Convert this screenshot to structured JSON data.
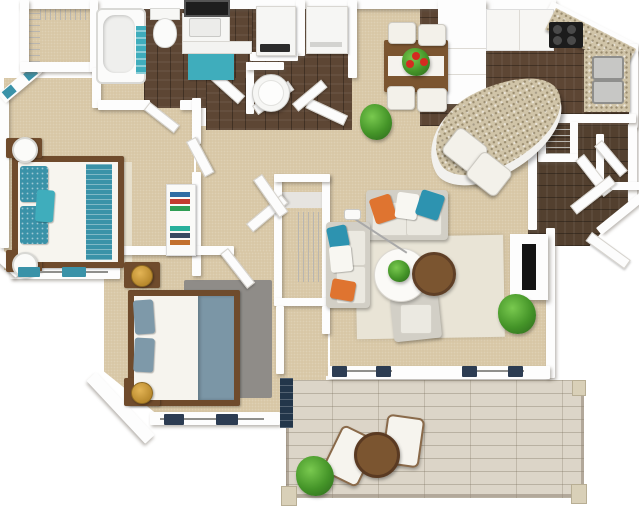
{
  "floorplan": {
    "type": "3d-top-down-apartment-floor-plan",
    "colors": {
      "carpet": "#d8c7a6",
      "wood-dark": "#5d4634",
      "wood-entry": "#53402f",
      "patio-wood": "#dcd5c8",
      "patio-line": "#8f8474",
      "wall": "#fdfdfd",
      "teal": "#3fadbc",
      "teal-deep": "#3a92a8",
      "navy": "#2c3c52",
      "blue-gray": "#7b96a6",
      "orange": "#df7430",
      "blue-pillow": "#2d93b0",
      "sofa": "#d2cfc6",
      "cushion": "#f3f1ea",
      "rug-cream": "#e9e4d6",
      "rug-gray": "#8f8c88",
      "furn-wood": "#6f4b2c",
      "table-wood": "#7b5530",
      "granite": "#d0c4a8",
      "gold": "#b98a2e",
      "plant": "#449428",
      "flower": "#d42b20",
      "tv": "#141414",
      "appliance": "#f6f6f4",
      "door-dark": "#23364a",
      "mirror": "#1e1e1e"
    },
    "rooms": [
      {
        "name": "walk-in-closet",
        "floor": "carpet",
        "features": [
          "wire-shelving"
        ]
      },
      {
        "name": "bathroom",
        "floor": "dark-wood",
        "features": [
          "bathtub",
          "teal-towels",
          "toilet",
          "vanity-sink",
          "mirror",
          "teal-bath-mat"
        ]
      },
      {
        "name": "laundry-closet",
        "floor": "dark-wood",
        "features": [
          "washer",
          "dryer",
          "water-heater"
        ]
      },
      {
        "name": "dining-area",
        "floor": "carpet",
        "features": [
          "wood-dining-table",
          "white-runner",
          "red-flower-centerpiece",
          "four-white-chairs",
          "potted-plant"
        ]
      },
      {
        "name": "kitchen",
        "floor": "dark-wood",
        "features": [
          "refrigerator-cabinet-column",
          "white-counter",
          "black-cooktop",
          "granite-corner-counter",
          "double-sink",
          "curved-granite-breakfast-bar",
          "two-bar-chairs",
          "pantry-shelves"
        ]
      },
      {
        "name": "entry-hall",
        "floor": "dark-wood",
        "features": [
          "front-door",
          "coat-closet",
          "open-doors"
        ]
      },
      {
        "name": "living-room",
        "floor": "carpet",
        "features": [
          "two-sofas",
          "orange-blue-white-pillows",
          "armchair",
          "round-white-coffee-table",
          "round-wood-side-table",
          "arc-floor-lamp",
          "tv-console",
          "flat-tv",
          "cream-area-rug",
          "potted-plant",
          "navy-curtain-windows"
        ]
      },
      {
        "name": "hallway",
        "floor": "carpet",
        "features": [
          "linen-closet-wire-shelves",
          "open-doors"
        ]
      },
      {
        "name": "bedroom-1",
        "floor": "carpet",
        "features": [
          "bed-teal-runner",
          "teal-patterned-pillows",
          "two-nightstands",
          "white-lamps",
          "bookshelf-with-books",
          "teal-curtain-windows",
          "angled-corner-window"
        ]
      },
      {
        "name": "bedroom-2",
        "floor": "carpet",
        "features": [
          "bed-blue-gray-blanket",
          "gray-area-rug",
          "two-nightstands",
          "gold-lamps",
          "navy-curtain-windows",
          "dark-patio-door"
        ]
      },
      {
        "name": "patio",
        "floor": "whitewashed-deck",
        "features": [
          "railing-with-posts",
          "two-loungers",
          "round-wood-table",
          "green-bush"
        ]
      }
    ]
  }
}
